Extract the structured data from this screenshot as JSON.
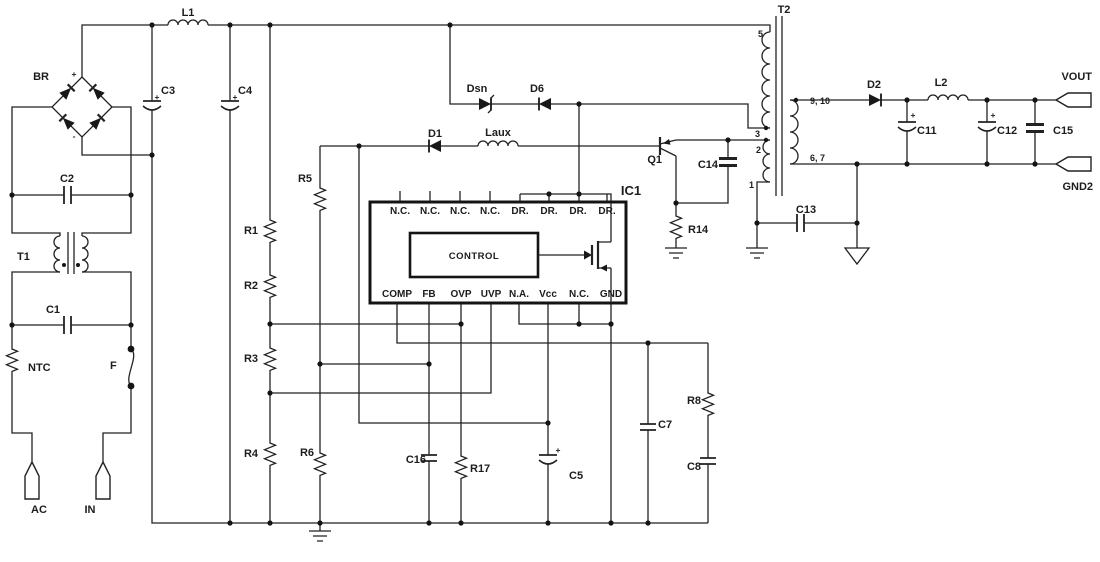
{
  "schematic": {
    "marks": {
      "plus": "+",
      "minus": "-"
    },
    "input": {
      "bridge": "BR",
      "l1": "L1",
      "c2": "C2",
      "c3": "C3",
      "c4": "C4",
      "t1": "T1",
      "c1": "C1",
      "ntc": "NTC",
      "fuse": "F",
      "ac_label": "AC",
      "in_label": "IN"
    },
    "bus": {
      "r1": "R1",
      "r2": "R2",
      "r3": "R3",
      "r4": "R4"
    },
    "aux": {
      "r5": "R5",
      "r6": "R6",
      "d1": "D1",
      "laux": "Laux",
      "dsn": "Dsn",
      "d6": "D6",
      "q1": "Q1",
      "c14": "C14",
      "r14": "R14"
    },
    "ic1": {
      "label": "IC1",
      "control": "CONTROL",
      "top_pins": [
        "N.C.",
        "N.C.",
        "N.C.",
        "N.C.",
        "DR.",
        "DR.",
        "DR.",
        "DR."
      ],
      "bottom_pins": [
        "COMP",
        "FB",
        "OVP",
        "UVP",
        "N.A.",
        "Vcc",
        "N.C.",
        "GND"
      ]
    },
    "lower": {
      "c16": "C16",
      "r17": "R17",
      "c5": "C5",
      "c7": "C7",
      "r8": "R8",
      "c8": "C8"
    },
    "t2": {
      "label": "T2",
      "pin5": "5",
      "pin3": "3",
      "pin2": "2",
      "pin1": "1",
      "sec_top": "9, 10",
      "sec_bot": "6, 7",
      "c13": "C13"
    },
    "output": {
      "d2": "D2",
      "l2": "L2",
      "c11": "C11",
      "c12": "C12",
      "c15": "C15",
      "vout": "VOUT",
      "gnd2": "GND2"
    }
  }
}
